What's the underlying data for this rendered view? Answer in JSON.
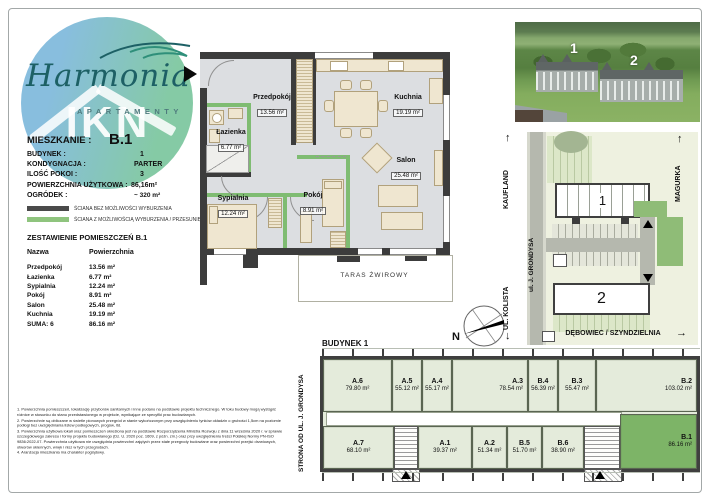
{
  "colors": {
    "wall_dark": "#3c3c3c",
    "wall_green": "#7fbc72",
    "floor_gray": "#dcdee1",
    "apartment_sage": "#e4ebdb",
    "highlight_green": "#7db467",
    "logo_blue": "#7fb9dc",
    "logo_green": "#7cc69e",
    "brand_teal": "#1d6065"
  },
  "logo": {
    "brand": "Harmonia",
    "sub": "APARTAMENTY",
    "watermark": "IKN"
  },
  "info": {
    "mieszkanie_label": "MIESZKANIE :",
    "mieszkanie_value": "B.1",
    "rows": [
      {
        "label": "BUDYNEK :",
        "value": "1"
      },
      {
        "label": "KONDYGNACJA :",
        "value": "PARTER"
      },
      {
        "label": "ILOŚĆ POKOI :",
        "value": "3"
      },
      {
        "label": "POWIERZCHNIA UŻYTKOWA :",
        "value": "86,16m²"
      },
      {
        "label": "OGRÓDEK :",
        "value": "~ 320 m²"
      }
    ]
  },
  "legend": {
    "items": [
      {
        "color": "#4a4a4a",
        "label": "ŚCIANA BEZ MOŻLIWOŚCI WYBURZENIA"
      },
      {
        "color": "#8fc47e",
        "label": "ŚCIANA Z MOŻLIWOŚCIĄ WYBURZENIA / PRZESUNIĘCIA"
      }
    ]
  },
  "rooms": {
    "title": "ZESTAWIENIE POMIESZCZEŃ B.1",
    "col_name": "Nazwa",
    "col_area": "Powierzchnia",
    "rows": [
      {
        "name": "Przedpokój",
        "area": "13.56 m²"
      },
      {
        "name": "Łazienka",
        "area": "6.77 m²"
      },
      {
        "name": "Sypialnia",
        "area": "12.24 m²"
      },
      {
        "name": "Pokój",
        "area": "8.91 m²"
      },
      {
        "name": "Salon",
        "area": "25.48 m²"
      },
      {
        "name": "Kuchnia",
        "area": "19.19 m²"
      },
      {
        "name": "SUMA: 6",
        "area": "86.16 m²"
      }
    ]
  },
  "floorplan": {
    "rooms": [
      {
        "name": "Przedpokój",
        "area": "13.56 m²"
      },
      {
        "name": "Łazienka",
        "area": "6.77 m²"
      },
      {
        "name": "Kuchnia",
        "area": "19.19 m²"
      },
      {
        "name": "Salon",
        "area": "25.48 m²"
      },
      {
        "name": "Sypialnia",
        "area": "12.24 m²"
      },
      {
        "name": "Pokój",
        "area": "8.91 m²"
      }
    ],
    "terrace": "TARAS ŻWIROWY",
    "compass_north": "N"
  },
  "photo": {
    "building1": "1",
    "building2": "2"
  },
  "sitemap": {
    "street_left_top": "KAUFLAND",
    "street_left_bottom": "UL. KOLISTA",
    "road": "ul. J. GRONDYSA",
    "street_right": "MAGURKA",
    "street_bottom": "DĘBOWIEC / SZYNDZIELNIA",
    "arrow_up": "↑",
    "arrow_down": "↓",
    "arrow_right": "→",
    "building1": "1",
    "building2": "2"
  },
  "building": {
    "title": "BUDYNEK 1",
    "side_label": "STRONA OD UL. J. GRONDYSA",
    "apartments": [
      {
        "name": "A.6",
        "area": "79.80 m²"
      },
      {
        "name": "A.5",
        "area": "55.12 m²"
      },
      {
        "name": "A.4",
        "area": "55.17 m²"
      },
      {
        "name": "A.3",
        "area": "78.54 m²"
      },
      {
        "name": "B.4",
        "area": "56.39 m²"
      },
      {
        "name": "B.3",
        "area": "55.47 m²"
      },
      {
        "name": "B.2",
        "area": "103.02 m²"
      },
      {
        "name": "A.7",
        "area": "68.10 m²"
      },
      {
        "name": "A.1",
        "area": "39.37 m²"
      },
      {
        "name": "A.2",
        "area": "51.34 m²"
      },
      {
        "name": "B.5",
        "area": "51.70 m²"
      },
      {
        "name": "B.6",
        "area": "38.90 m²"
      },
      {
        "name": "B.1",
        "area": "86.16 m²"
      }
    ]
  },
  "notes": [
    "1. Powierzchnia pomieszczeń, lokalizację przyborów sanitarnych i inne podano na podstawie projektu technicznego. W toku budowy mogą wystąpić różnice w stosunku do stanu przedstawionego w projekcie, wynikające ze specyfiki prac budowlanych.",
    "2. Powierzchnie są obliczane w świetle pionowych przegród w stanie wykończonym przy uwzględnieniu tynków okładzin o grubości 1,5cm na poziomie podłogi bez uwzględniania listew podłogowych, progów, itd.",
    "3. Powierzchnia użytkowa lokali oraz pomieszczeń określona jest na podstawie Rozporządzenia Ministra Rozwoju z dnia 11 września 2020 r. w sprawie szczegółowego zakresu i formy projektu budowlanego (Dz. U. 2020 poz. 1609, z późn. zm.) oraz przy uwzględnieniu treści Polskiej Normy PN-ISO 9836:2022-07. Powierzchnia użytkowa nie uwzględnia powierzchni zajętych przez stałe przegrody budowlane oraz powierzchni przejść drzwiowych, otworów okiennych, wnęk i nisz w tych przegrodach.",
    "4. Aranżacja mieszkania ma charakter poglądowy."
  ]
}
